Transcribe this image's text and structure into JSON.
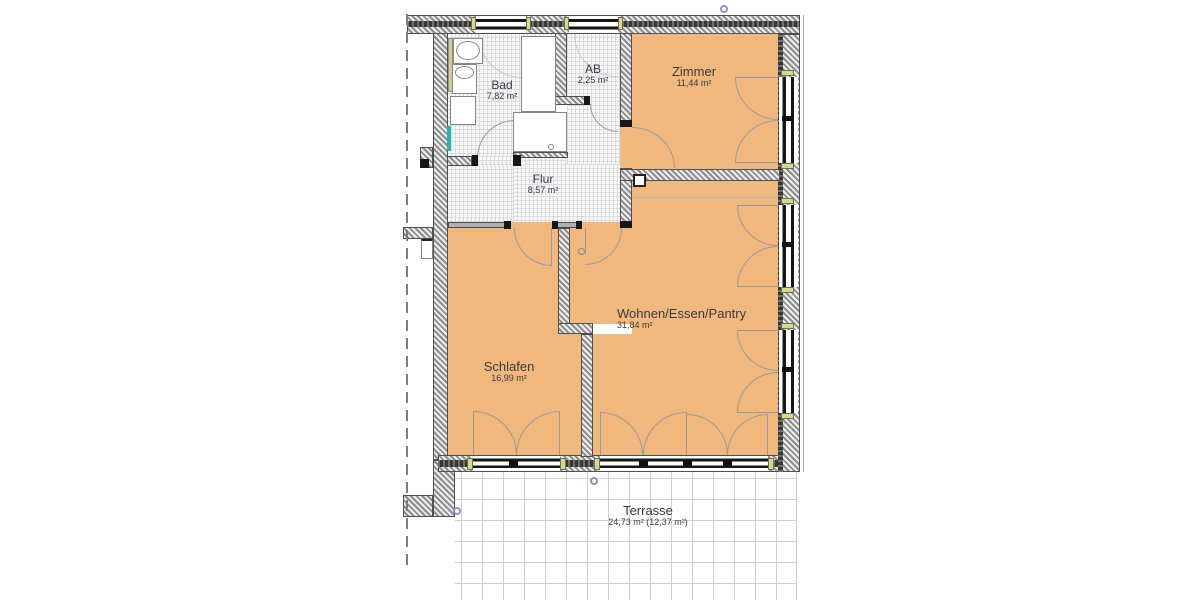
{
  "plan": {
    "type": "apartment-floor-plan",
    "language": "de"
  },
  "rooms": {
    "bad": {
      "name": "Bad",
      "area": "7,82 m²"
    },
    "ab": {
      "name": "AB",
      "area": "2,25 m²"
    },
    "zimmer": {
      "name": "Zimmer",
      "area": "11,44 m²"
    },
    "flur": {
      "name": "Flur",
      "area": "8,57 m²"
    },
    "schlafen": {
      "name": "Schlafen",
      "area": "16,99 m²"
    },
    "wohnen": {
      "name": "Wohnen/Essen/Pantry",
      "area": "31,84 m²"
    },
    "terrasse": {
      "name": "Terrasse",
      "area": "24,73 m² (12,37 m²)"
    }
  },
  "colors": {
    "room_fill": "#f0b87d",
    "wall_dark": "#383838",
    "tile_floor": "#f7f7f7",
    "terrace_grid": "#cfcfcf",
    "window_sill": "#d6d98a",
    "radiator": "#27b5a9",
    "survey_marker": "#8d8dd2"
  }
}
